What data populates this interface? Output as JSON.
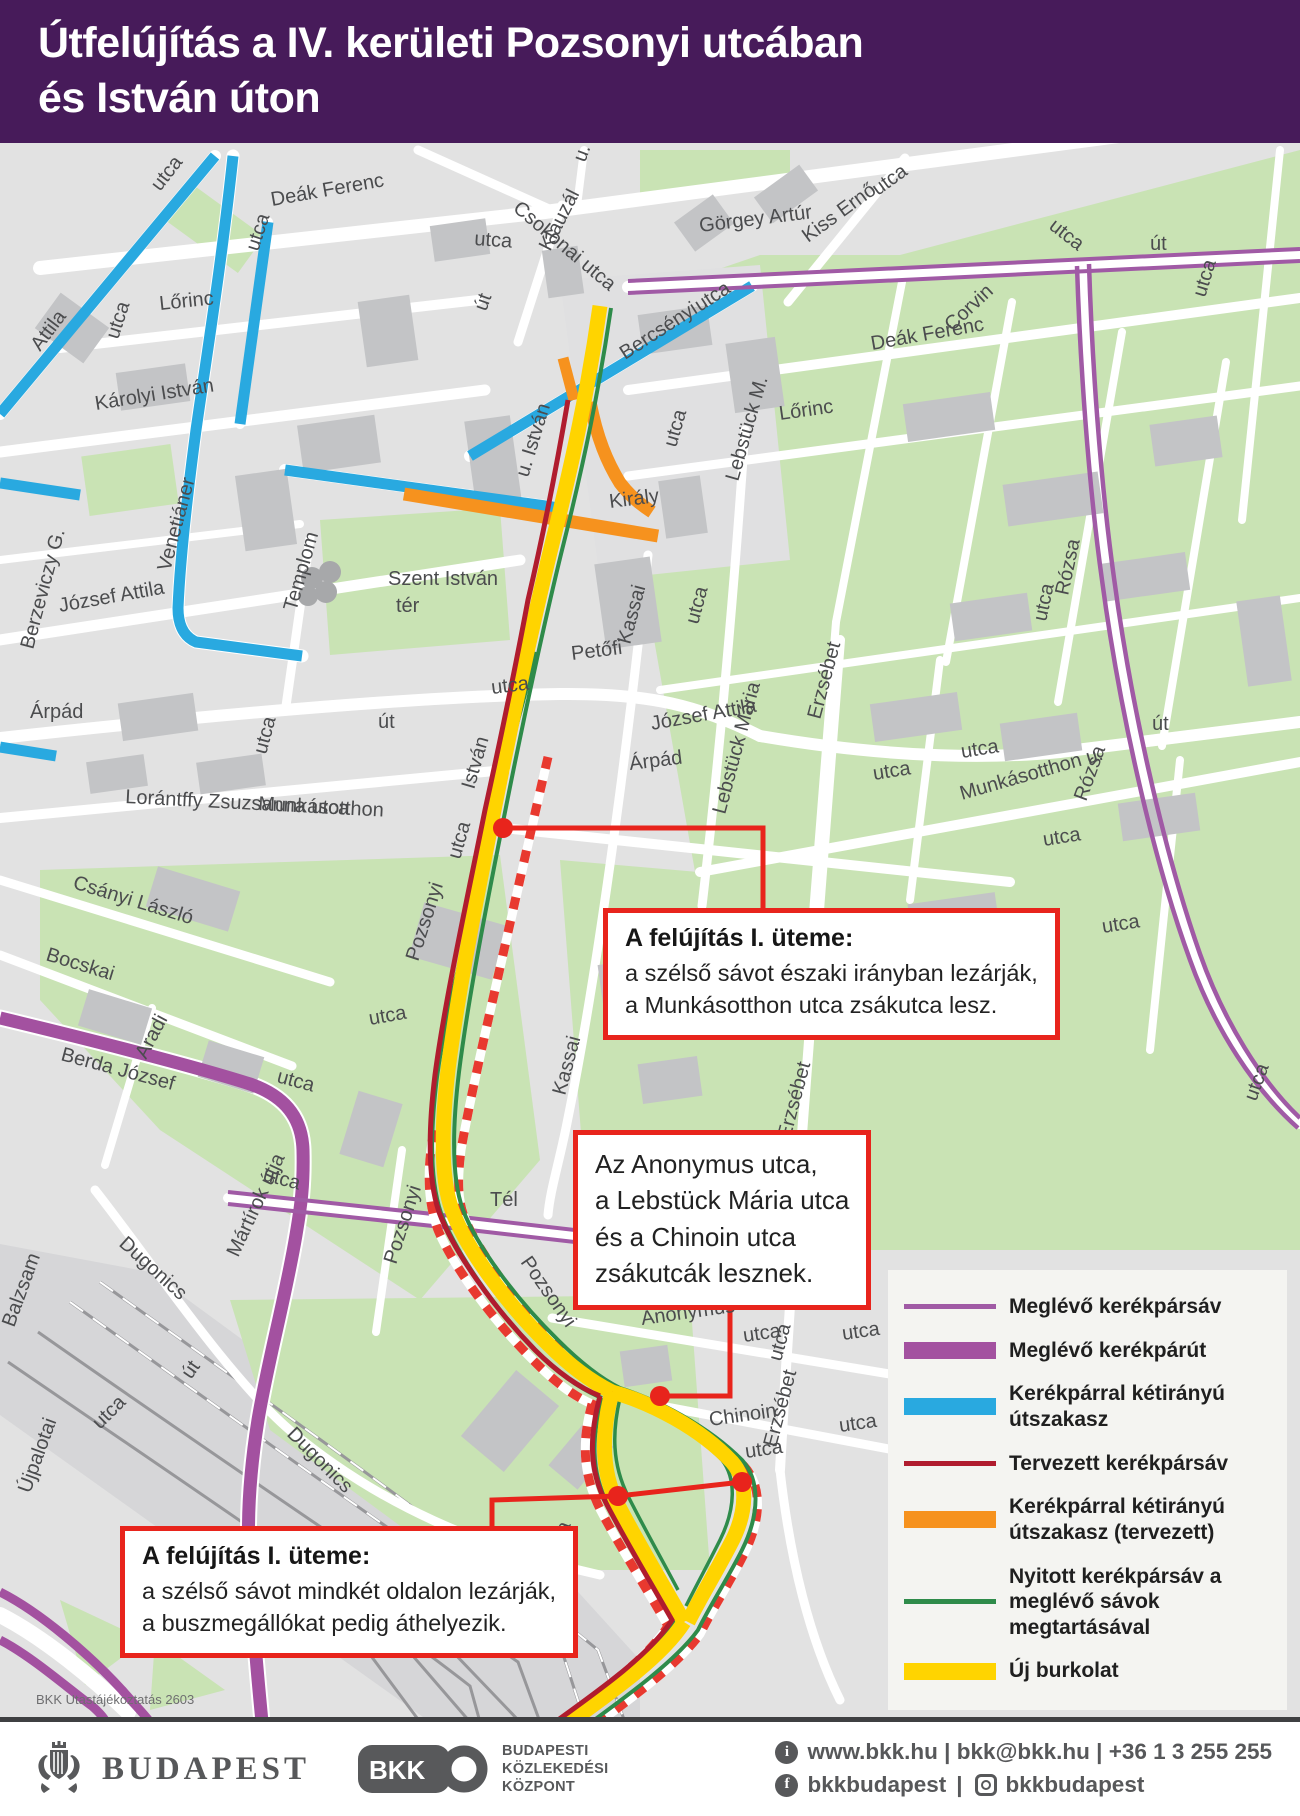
{
  "header": {
    "title_line1": "Útfelújítás a IV. kerületi Pozsonyi utcában",
    "title_line2": "és István úton"
  },
  "map": {
    "credit": "BKK Utastájékoztatás 2603",
    "colors": {
      "existing_bike_lane": "#a05aa5",
      "existing_bike_path": "#a351a0",
      "two_way_bike_section": "#29a9e0",
      "planned_bike_lane": "#b01c2e",
      "two_way_planned": "#f6921e",
      "open_bike_lane": "#2e8b4a",
      "new_pavement": "#ffd400",
      "closure_stripe": "#e8392f",
      "callout_red": "#e8241c"
    },
    "street_labels": [
      {
        "t": "utca",
        "x": 160,
        "y": 192,
        "r": -52
      },
      {
        "t": "Deák Ferenc",
        "x": 272,
        "y": 206,
        "r": -10
      },
      {
        "t": "utca",
        "x": 258,
        "y": 252,
        "r": -72
      },
      {
        "t": "Csokonai utca",
        "x": 512,
        "y": 210,
        "r": 40
      },
      {
        "t": "Klauzál",
        "x": 550,
        "y": 252,
        "r": -63
      },
      {
        "t": "u.",
        "x": 585,
        "y": 163,
        "r": -70
      },
      {
        "t": "Görgey Artúr",
        "x": 700,
        "y": 232,
        "r": -7
      },
      {
        "t": "Kiss Ernő",
        "x": 808,
        "y": 243,
        "r": -36
      },
      {
        "t": "utca",
        "x": 878,
        "y": 196,
        "r": -36
      },
      {
        "t": "utca",
        "x": 1048,
        "y": 228,
        "r": 38
      },
      {
        "t": "út",
        "x": 1150,
        "y": 250,
        "r": 0
      },
      {
        "t": "utca",
        "x": 1205,
        "y": 298,
        "r": -73
      },
      {
        "t": "Attila",
        "x": 40,
        "y": 352,
        "r": -53
      },
      {
        "t": "Lőrinc",
        "x": 160,
        "y": 310,
        "r": -6
      },
      {
        "t": "utca",
        "x": 118,
        "y": 340,
        "r": -72
      },
      {
        "t": "Károlyi István",
        "x": 96,
        "y": 410,
        "r": -9
      },
      {
        "t": "utca",
        "x": 474,
        "y": 245,
        "r": 4
      },
      {
        "t": "út",
        "x": 486,
        "y": 312,
        "r": -70
      },
      {
        "t": "Bercsényi",
        "x": 625,
        "y": 360,
        "r": -33
      },
      {
        "t": "utca",
        "x": 700,
        "y": 312,
        "r": -33
      },
      {
        "t": "Lőrinc",
        "x": 780,
        "y": 420,
        "r": -8
      },
      {
        "t": "Deák Ferenc",
        "x": 872,
        "y": 350,
        "r": -10
      },
      {
        "t": "Corvin",
        "x": 952,
        "y": 332,
        "r": -43
      },
      {
        "t": "Lebstück M.",
        "x": 738,
        "y": 482,
        "r": -74
      },
      {
        "t": "utca",
        "x": 676,
        "y": 448,
        "r": -74
      },
      {
        "t": "Király",
        "x": 610,
        "y": 508,
        "r": -7
      },
      {
        "t": "u. István",
        "x": 528,
        "y": 478,
        "r": -73
      },
      {
        "t": "Templom",
        "x": 296,
        "y": 612,
        "r": -74
      },
      {
        "t": "Szent István",
        "x": 388,
        "y": 585,
        "r": 0
      },
      {
        "t": "tér",
        "x": 396,
        "y": 612,
        "r": 0
      },
      {
        "t": "Kassai",
        "x": 630,
        "y": 645,
        "r": -75
      },
      {
        "t": "utca",
        "x": 698,
        "y": 625,
        "r": -75
      },
      {
        "t": "Petőfi",
        "x": 572,
        "y": 660,
        "r": -7
      },
      {
        "t": "utca",
        "x": 492,
        "y": 694,
        "r": -7
      },
      {
        "t": "út",
        "x": 378,
        "y": 728,
        "r": 0
      },
      {
        "t": "József Attila",
        "x": 652,
        "y": 730,
        "r": -10
      },
      {
        "t": "Árpád",
        "x": 630,
        "y": 770,
        "r": -7
      },
      {
        "t": "Lebstück Mária",
        "x": 725,
        "y": 815,
        "r": -75
      },
      {
        "t": "Erzsébet",
        "x": 820,
        "y": 720,
        "r": -75
      },
      {
        "t": "utca",
        "x": 874,
        "y": 780,
        "r": -9
      },
      {
        "t": "utca",
        "x": 962,
        "y": 758,
        "r": -9
      },
      {
        "t": "Munkásotthon u.",
        "x": 962,
        "y": 800,
        "r": -16
      },
      {
        "t": "Rózsa",
        "x": 1068,
        "y": 596,
        "r": -78
      },
      {
        "t": "utca",
        "x": 1046,
        "y": 622,
        "r": -78
      },
      {
        "t": "út",
        "x": 1152,
        "y": 730,
        "r": 0
      },
      {
        "t": "Rózsa",
        "x": 1086,
        "y": 802,
        "r": -70
      },
      {
        "t": "utca",
        "x": 1044,
        "y": 846,
        "r": -9
      },
      {
        "t": "utca",
        "x": 1103,
        "y": 933,
        "r": -9
      },
      {
        "t": "utca",
        "x": 1256,
        "y": 1102,
        "r": -70
      },
      {
        "t": "József Attila",
        "x": 60,
        "y": 612,
        "r": -10
      },
      {
        "t": "Berzeviczy G.",
        "x": 33,
        "y": 650,
        "r": -75
      },
      {
        "t": "Venetiáner",
        "x": 170,
        "y": 572,
        "r": -75
      },
      {
        "t": "Árpád",
        "x": 30,
        "y": 718,
        "r": 0
      },
      {
        "t": "utca",
        "x": 266,
        "y": 755,
        "r": -75
      },
      {
        "t": "Lorántffy Zsuzsanna utca",
        "x": 125,
        "y": 803,
        "r": 3
      },
      {
        "t": "Munkásotthon",
        "x": 258,
        "y": 810,
        "r": 3
      },
      {
        "t": "utca",
        "x": 460,
        "y": 860,
        "r": -74
      },
      {
        "t": "István",
        "x": 474,
        "y": 790,
        "r": -74
      },
      {
        "t": "Pozsonyi",
        "x": 418,
        "y": 962,
        "r": -72
      },
      {
        "t": "utca",
        "x": 370,
        "y": 1025,
        "r": -10
      },
      {
        "t": "Csányi László",
        "x": 72,
        "y": 888,
        "r": 17
      },
      {
        "t": "Bocskai",
        "x": 45,
        "y": 960,
        "r": 17
      },
      {
        "t": "Berda József",
        "x": 60,
        "y": 1060,
        "r": 15
      },
      {
        "t": "Aradi",
        "x": 146,
        "y": 1060,
        "r": -62
      },
      {
        "t": "utca",
        "x": 276,
        "y": 1082,
        "r": 15
      },
      {
        "t": "utca",
        "x": 262,
        "y": 1180,
        "r": 15
      },
      {
        "t": "Dugonics",
        "x": 118,
        "y": 1245,
        "r": 42
      },
      {
        "t": "Mártírok útja",
        "x": 238,
        "y": 1258,
        "r": -65
      },
      {
        "t": "Kassai",
        "x": 565,
        "y": 1096,
        "r": -75
      },
      {
        "t": "Tél",
        "x": 490,
        "y": 1206,
        "r": 0
      },
      {
        "t": "Pozsonyi",
        "x": 396,
        "y": 1265,
        "r": -72
      },
      {
        "t": "Pozsonyi",
        "x": 520,
        "y": 1262,
        "r": 55
      },
      {
        "t": "Anonymus",
        "x": 642,
        "y": 1325,
        "r": -8
      },
      {
        "t": "utca",
        "x": 744,
        "y": 1342,
        "r": -8
      },
      {
        "t": "Chinoin",
        "x": 710,
        "y": 1426,
        "r": -8
      },
      {
        "t": "utca",
        "x": 746,
        "y": 1458,
        "r": -8
      },
      {
        "t": "Erzsébet",
        "x": 776,
        "y": 1448,
        "r": -75
      },
      {
        "t": "utca",
        "x": 781,
        "y": 1362,
        "r": -75
      },
      {
        "t": "Erzsébet",
        "x": 790,
        "y": 1140,
        "r": -75
      },
      {
        "t": "utca",
        "x": 843,
        "y": 1340,
        "r": -8
      },
      {
        "t": "utca",
        "x": 840,
        "y": 1432,
        "r": -8
      },
      {
        "t": "Balzsam",
        "x": 14,
        "y": 1328,
        "r": -70
      },
      {
        "t": "Újpalotai",
        "x": 30,
        "y": 1494,
        "r": -70
      },
      {
        "t": "utca",
        "x": 100,
        "y": 1430,
        "r": -45
      },
      {
        "t": "út",
        "x": 191,
        "y": 1380,
        "r": -55
      },
      {
        "t": "Dugonics",
        "x": 286,
        "y": 1435,
        "r": 45
      },
      {
        "t": "utca",
        "x": 558,
        "y": 1560,
        "r": -70
      }
    ],
    "callouts": [
      {
        "title": "A felújítás I. üteme:",
        "lines": [
          "a szélső sávot északi irányban lezárják,",
          "a Munkásotthon utca zsákutca lesz."
        ]
      },
      {
        "title": "",
        "lines": [
          "Az Anonymus utca,",
          "a Lebstück Mária utca",
          "és a Chinoin utca",
          "zsákutcák lesznek."
        ]
      },
      {
        "title": "A felújítás I. üteme:",
        "lines": [
          "a szélső sávot mindkét oldalon lezárják,",
          "a buszmegállókat pedig áthelyezik."
        ]
      }
    ],
    "legend": {
      "items": [
        {
          "swatch": "line",
          "color": "#a05aa5",
          "label": "Meglévő kerékpársáv"
        },
        {
          "swatch": "bar",
          "color": "#a351a0",
          "label": "Meglévő kerékpárút"
        },
        {
          "swatch": "bar",
          "color": "#29a9e0",
          "label": "Kerékpárral kétirányú útszakasz"
        },
        {
          "swatch": "line",
          "color": "#b01c2e",
          "label": "Tervezett kerékpársáv"
        },
        {
          "swatch": "bar",
          "color": "#f6921e",
          "label": "Kerékpárral kétirányú útszakasz (tervezett)"
        },
        {
          "swatch": "line",
          "color": "#2e8b4a",
          "label": "Nyitott kerékpársáv a meglévő sávok megtartásával"
        },
        {
          "swatch": "bar",
          "color": "#ffd400",
          "label": "Új burkolat"
        }
      ]
    }
  },
  "footer": {
    "budapest_logo_text": "BUDAPEST",
    "bkk_logo_text": "BKK",
    "bkk_name_lines": [
      "BUDAPESTI",
      "KÖZLEKEDÉSI",
      "KÖZPONT"
    ],
    "info_icon_glyph": "i",
    "facebook_icon_glyph": "f",
    "contact_line": "www.bkk.hu | bkk@bkk.hu | +36 1 3 255 255",
    "facebook_handle": "bkkbudapest",
    "instagram_handle": "bkkbudapest",
    "separator": "|"
  }
}
